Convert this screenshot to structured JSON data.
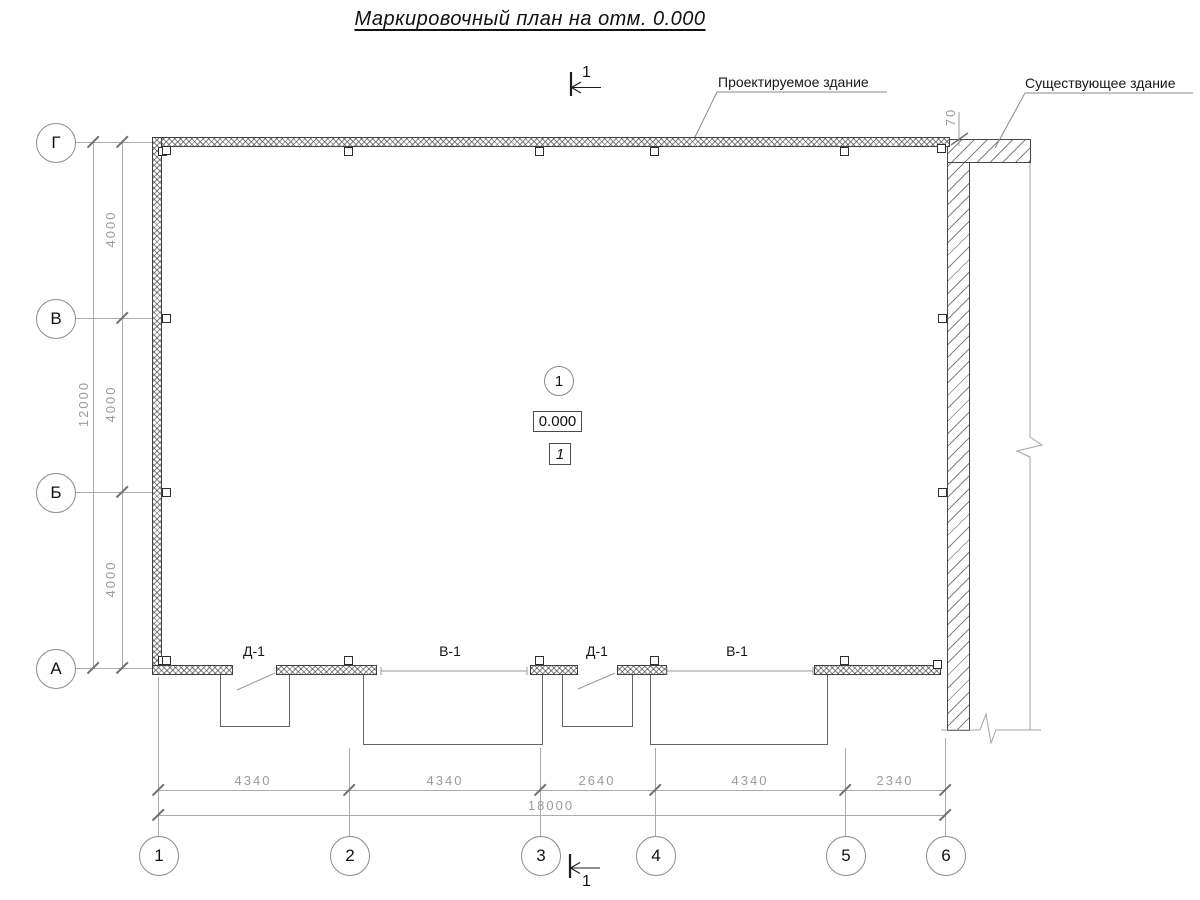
{
  "title": "Маркировочный план на отм. 0.000",
  "callouts": {
    "projected_building": "Проектируемое здание",
    "existing_building": "Существующее здание"
  },
  "section_mark_label": "1",
  "axes": {
    "rows": [
      "Г",
      "В",
      "Б",
      "А"
    ],
    "cols": [
      "1",
      "2",
      "3",
      "4",
      "5",
      "6"
    ]
  },
  "dimensions": {
    "left_segments": [
      "4000",
      "4000",
      "4000"
    ],
    "left_overall": "12000",
    "bottom_segments": [
      "4340",
      "4340",
      "2640",
      "4340",
      "2340"
    ],
    "bottom_overall": "18000",
    "gap_to_existing": "70"
  },
  "openings": {
    "labels": [
      "Д-1",
      "В-1",
      "Д-1",
      "В-1"
    ]
  },
  "annotations": {
    "node_number": "1",
    "level_mark": "0.000",
    "room_number": "1"
  }
}
